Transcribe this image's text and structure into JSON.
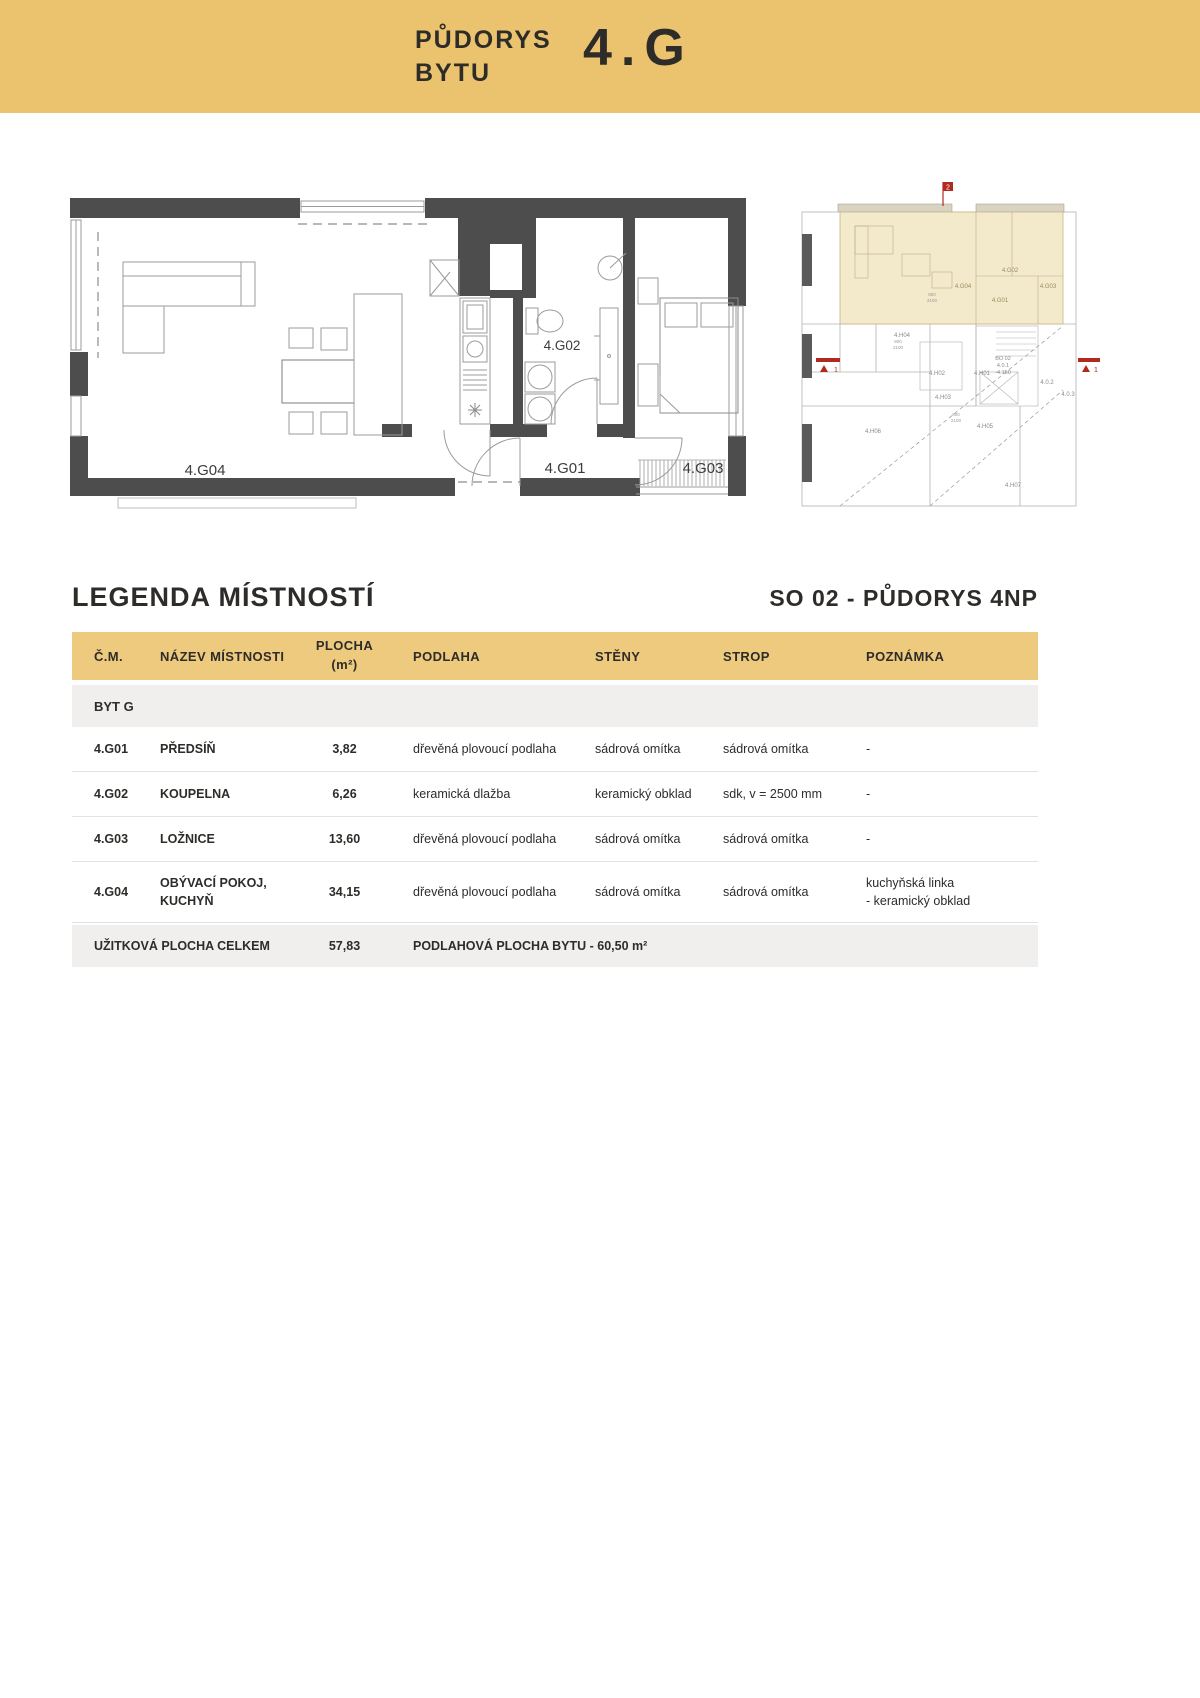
{
  "header": {
    "line1": "PŮDORYS",
    "line2": "BYTU",
    "unit": "4.G"
  },
  "plan": {
    "rooms": {
      "g01": "4.G01",
      "g02": "4.G02",
      "g03": "4.G03",
      "g04": "4.G04"
    }
  },
  "mini_plan": {
    "flat_rooms": {
      "g01": "4.G01",
      "g02": "4.G02",
      "g03": "4.G03",
      "g04": "4.G04"
    },
    "other_rooms": {
      "h01": "4.H01",
      "h02": "4.H02",
      "h03": "4.H03",
      "h04": "4.H04",
      "h05": "4.H05",
      "h06": "4.H06",
      "h07": "4.H07"
    },
    "core": {
      "l1": "BO 02",
      "l2": "4.0.1",
      "l3": "-4.150",
      "s1": "4.0.2",
      "s2": "4.0.3"
    },
    "markers": {
      "top": "2",
      "left": "1",
      "right": "1"
    },
    "dims": [
      "800",
      "2100"
    ]
  },
  "legend": {
    "title": "LEGENDA MÍSTNOSTÍ",
    "subtitle": "SO 02 - PŮDORYS 4NP"
  },
  "table": {
    "columns": {
      "c1": "Č.M.",
      "c2": "NÁZEV MÍSTNOSTI",
      "c3": "PLOCHA\n(m²)",
      "c4": "PODLAHA",
      "c5": "STĚNY",
      "c6": "STROP",
      "c7": "POZNÁMKA"
    },
    "group": "BYT G",
    "rows": [
      {
        "id": "4.G01",
        "name": "PŘEDSÍŇ",
        "area": "3,82",
        "floor": "dřevěná plovoucí podlaha",
        "walls": "sádrová omítka",
        "ceiling": "sádrová omítka",
        "note": "-"
      },
      {
        "id": "4.G02",
        "name": "KOUPELNA",
        "area": "6,26",
        "floor": "keramická dlažba",
        "walls": "keramický obklad",
        "ceiling": "sdk, v = 2500 mm",
        "note": "-"
      },
      {
        "id": "4.G03",
        "name": "LOŽNICE",
        "area": "13,60",
        "floor": "dřevěná plovoucí podlaha",
        "walls": "sádrová omítka",
        "ceiling": "sádrová omítka",
        "note": "-"
      },
      {
        "id": "4.G04",
        "name": "OBÝVACÍ POKOJ,\nKUCHYŇ",
        "area": "34,15",
        "floor": "dřevěná plovoucí podlaha",
        "walls": "sádrová omítka",
        "ceiling": "sádrová omítka",
        "note": "kuchyňská linka\n- keramický obklad"
      }
    ],
    "total": {
      "label": "UŽITKOVÁ PLOCHA CELKEM",
      "area": "57,83",
      "note": "PODLAHOVÁ PLOCHA BYTU - 60,50 m²"
    }
  },
  "colors": {
    "accent": "#ebc36e",
    "table_header": "#eeca7e",
    "wall": "#4d4d4d",
    "red": "#b22a1f",
    "beige": "#f3e9cb"
  }
}
